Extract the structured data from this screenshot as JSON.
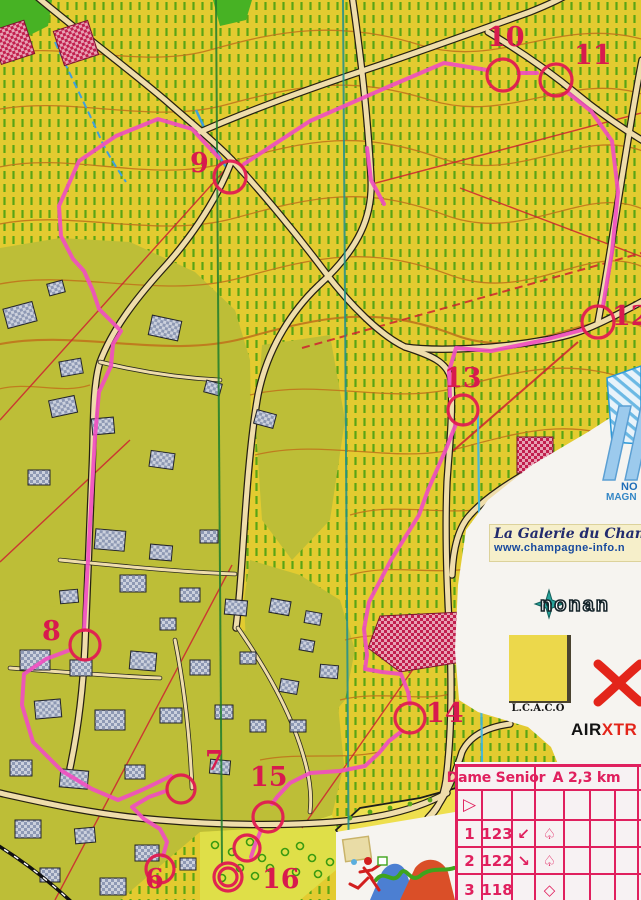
{
  "course_overlay": {
    "description": "pink course line with numbered red control circles",
    "controls": [
      {
        "label": "6"
      },
      {
        "label": "7"
      },
      {
        "label": "8"
      },
      {
        "label": "9"
      },
      {
        "label": "10"
      },
      {
        "label": "11"
      },
      {
        "label": "12"
      },
      {
        "label": "13"
      },
      {
        "label": "14"
      },
      {
        "label": "15"
      },
      {
        "label": "16"
      }
    ],
    "finish": "double circle"
  },
  "control_card": {
    "class_name": "Dame Senior",
    "course_info": "A 2,3 km",
    "start_symbol": "▷",
    "rows": [
      {
        "no": "1",
        "code": "123",
        "col_c": "↙",
        "col_d": "♤"
      },
      {
        "no": "2",
        "code": "122",
        "col_c": "↘",
        "col_d": "♤"
      },
      {
        "no": "3",
        "code": "118",
        "col_c": "",
        "col_d": "◇"
      }
    ]
  },
  "sponsors": {
    "blue_logo_line1": "NO",
    "blue_logo_line2": "MAGN",
    "champagne_title": "La Galerie du Champa",
    "champagne_url": "www.champagne-info.n",
    "nonan_text": "nonan",
    "lcaco_text": "L.C.A.C.O",
    "air_black": "AIR",
    "air_red": "XTR"
  },
  "colors": {
    "course_pink": "#f04fc0",
    "control_red": "#e11b52",
    "vineyard_yellow": "#e3cb30",
    "vine_row_green": "#5aa414",
    "card_red": "#e0205e"
  }
}
